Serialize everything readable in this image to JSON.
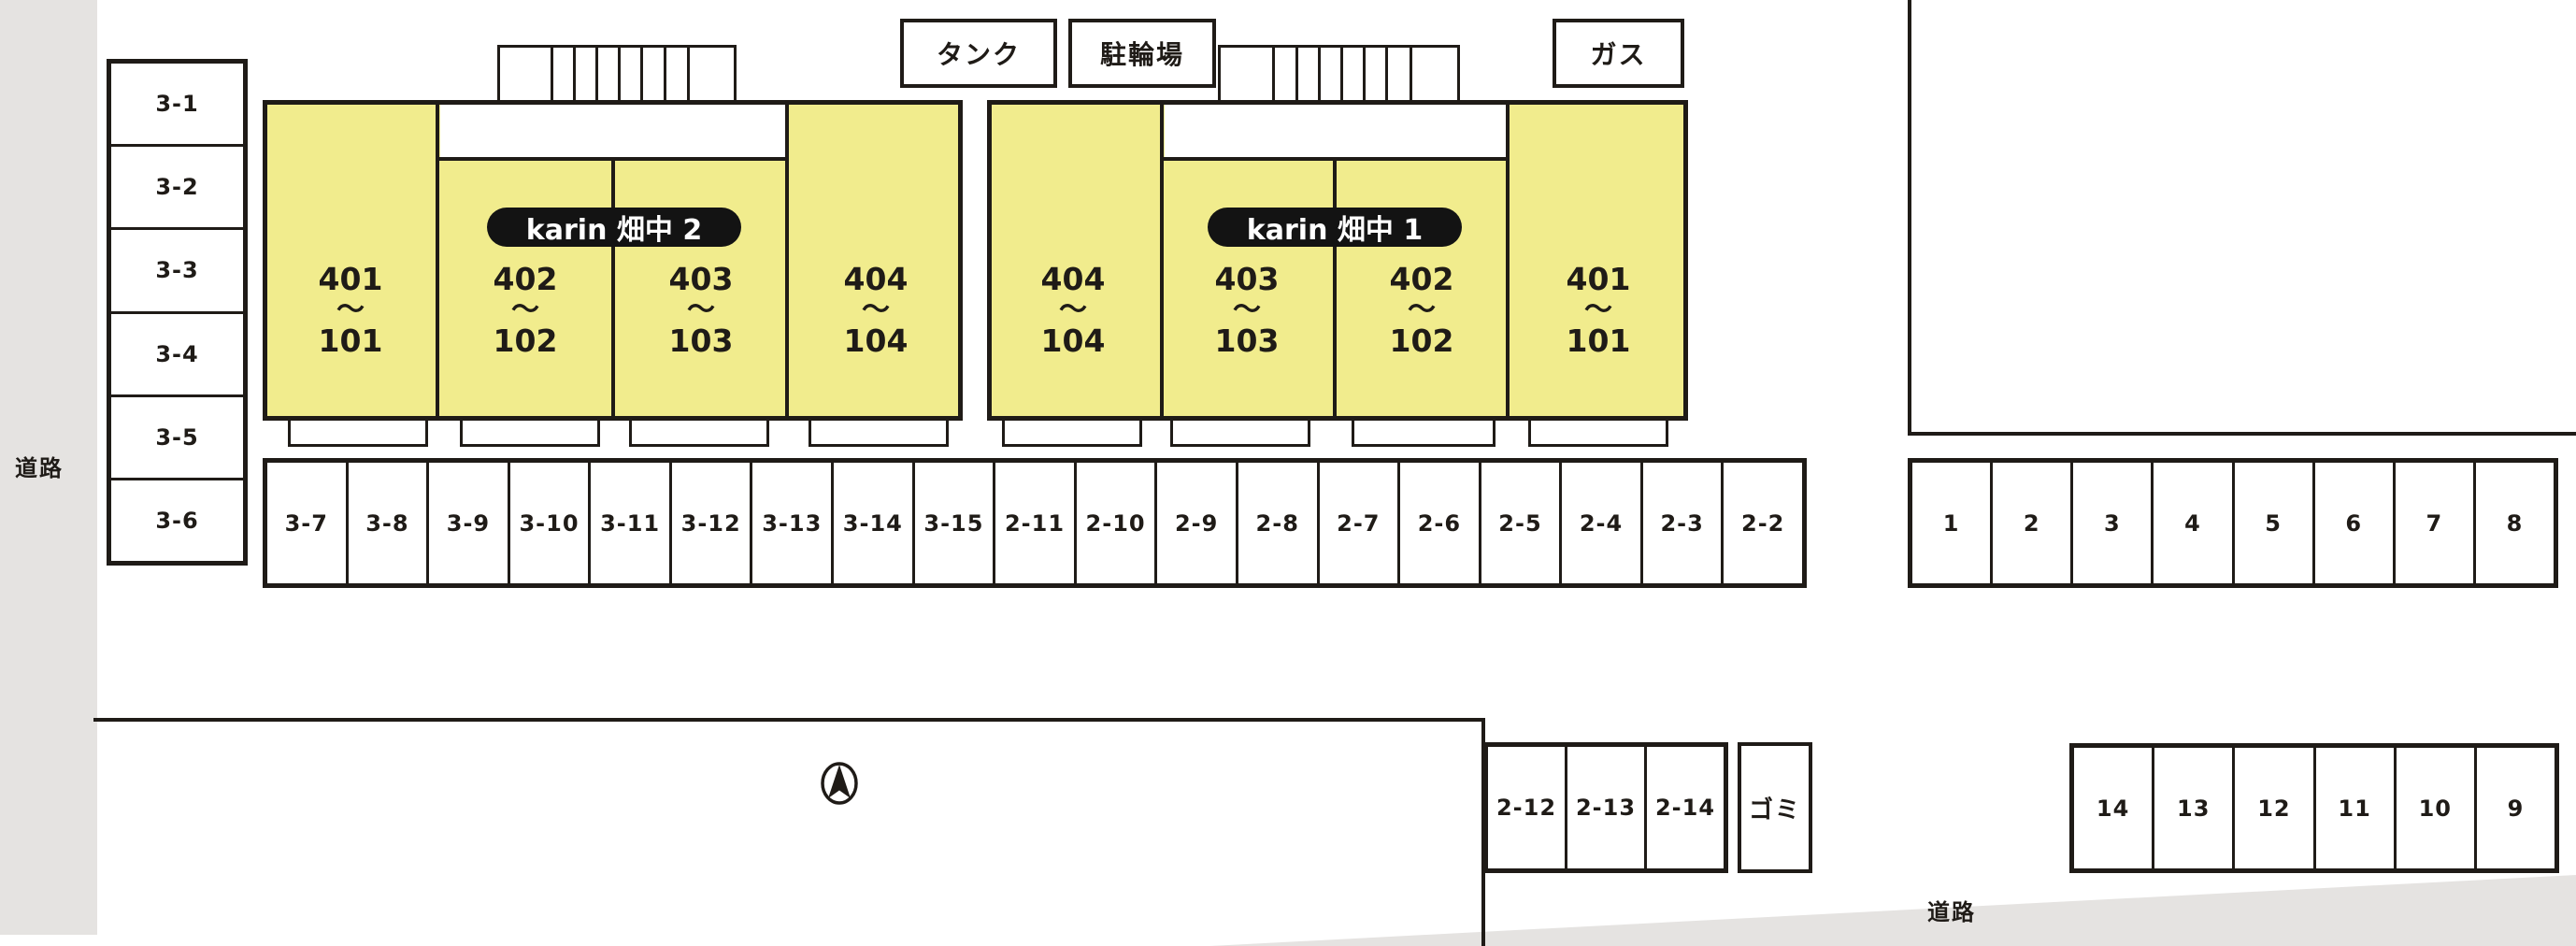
{
  "plan": {
    "roads": {
      "left_label": "道路",
      "bottom_label": "道路"
    },
    "facilities": {
      "tank": "タンク",
      "bicycle_parking": "駐輪場",
      "gas": "ガス",
      "garbage": "ゴミ"
    },
    "buildings": [
      {
        "name": "karin 畑中 2",
        "units": [
          {
            "top": "401",
            "tilde": "〜",
            "bottom": "101"
          },
          {
            "top": "402",
            "tilde": "〜",
            "bottom": "102"
          },
          {
            "top": "403",
            "tilde": "〜",
            "bottom": "103"
          },
          {
            "top": "404",
            "tilde": "〜",
            "bottom": "104"
          }
        ]
      },
      {
        "name": "karin 畑中 1",
        "units": [
          {
            "top": "404",
            "tilde": "〜",
            "bottom": "104"
          },
          {
            "top": "403",
            "tilde": "〜",
            "bottom": "103"
          },
          {
            "top": "402",
            "tilde": "〜",
            "bottom": "102"
          },
          {
            "top": "401",
            "tilde": "〜",
            "bottom": "101"
          }
        ]
      }
    ],
    "parking": {
      "left_column": [
        "3-1",
        "3-2",
        "3-3",
        "3-4",
        "3-5",
        "3-6"
      ],
      "main_row": [
        "3-7",
        "3-8",
        "3-9",
        "3-10",
        "3-11",
        "3-12",
        "3-13",
        "3-14",
        "3-15",
        "2-11",
        "2-10",
        "2-9",
        "2-8",
        "2-7",
        "2-6",
        "2-5",
        "2-4",
        "2-3",
        "2-2"
      ],
      "right_row": [
        "1",
        "2",
        "3",
        "4",
        "5",
        "6",
        "7",
        "8"
      ],
      "bottom_center_row": [
        "2-12",
        "2-13",
        "2-14"
      ],
      "bottom_right_row": [
        "14",
        "13",
        "12",
        "11",
        "10",
        "9"
      ]
    },
    "icons": {
      "compass": "north-arrow"
    },
    "colors": {
      "building_fill": "#f1ec8d",
      "road_fill": "#e5e3e1",
      "line": "#1f1b17",
      "pill_bg": "#131313",
      "pill_text": "#ffffff"
    }
  }
}
